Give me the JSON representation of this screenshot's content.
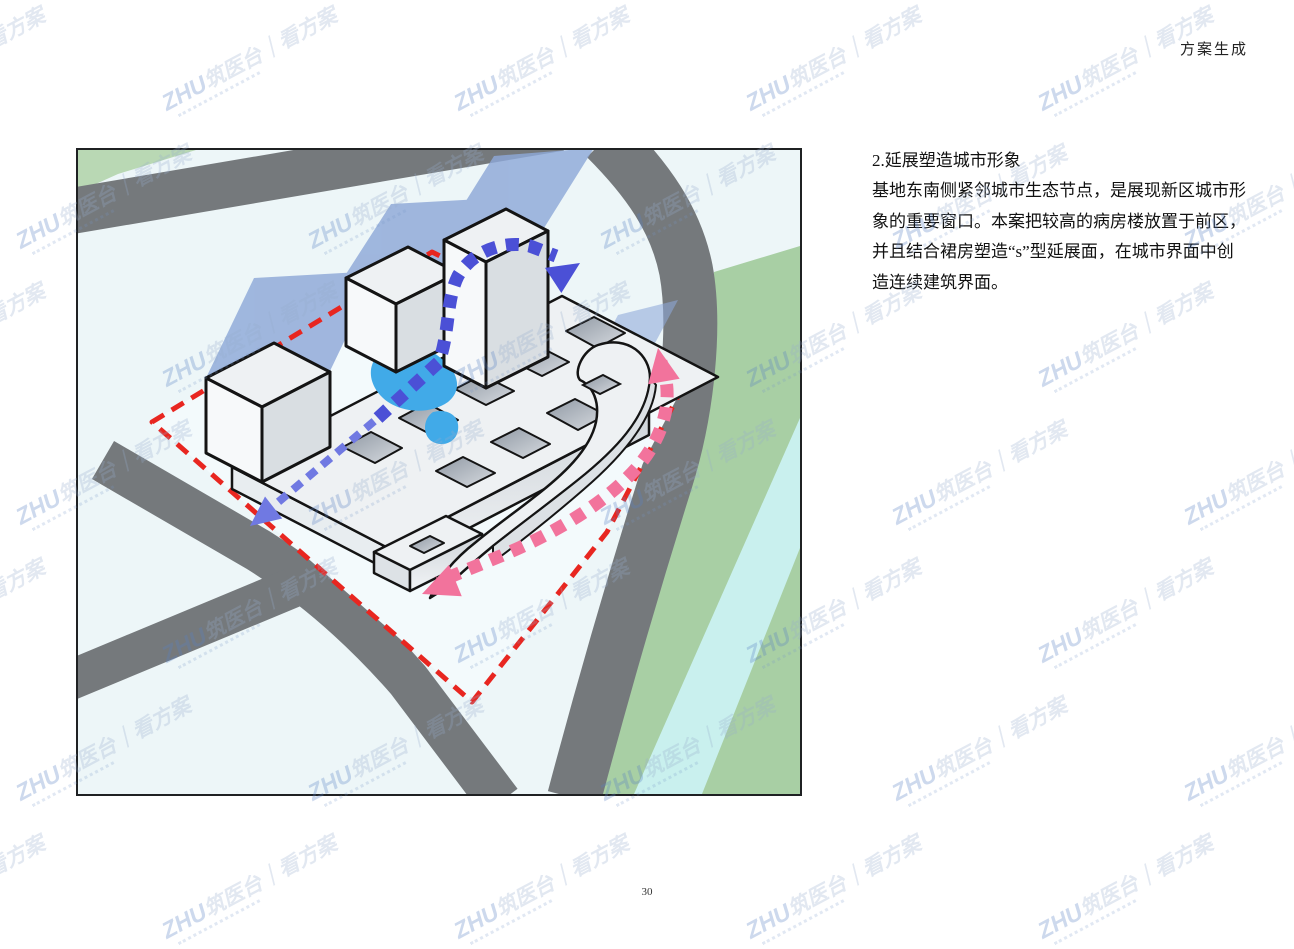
{
  "page": {
    "header_title": "方案生成",
    "page_number": "30"
  },
  "article": {
    "heading": "2.延展塑造城市形象",
    "body_text": "基地东南侧紧邻城市生态节点，是展现新区城市形\n象的重要窗口。本案把较高的病房楼放置于前区，\n并且结合裙房塑造“s”型延展面，在城市界面中创\n造连续建筑界面。"
  },
  "figure": {
    "type": "axonometric-site-massing-diagram",
    "elements": [
      "city-roads",
      "green-belt",
      "water-stripe",
      "red-dashed-site-boundary",
      "podium-slabs-with-courtyards",
      "three-ward-towers",
      "s-shaped-podium-wing",
      "central-pond",
      "tower-shadows",
      "blue-s-flow-arrow",
      "pink-perimeter-flow-arrow"
    ],
    "colors": {
      "road": "#75797c",
      "parcel": "#edf6f8",
      "site_ground": "#f3fafc",
      "green_belt": "#a8cfa4",
      "green_corner": "#b9d8b4",
      "water_stripe": "#c9f0ee",
      "boundary_red": "#e82620",
      "arrow_blue": "#4b50d6",
      "arrow_blue_light": "#7079e2",
      "arrow_pink": "#f2739c",
      "pond_blue": "#41aae8",
      "building_top": "#eef1f3",
      "building_front": "#d9dee2",
      "outline": "#141414",
      "shadow": "#8ea8d8"
    }
  },
  "watermark": {
    "brand": "ZHU",
    "main": "筑医台｜看方案"
  }
}
